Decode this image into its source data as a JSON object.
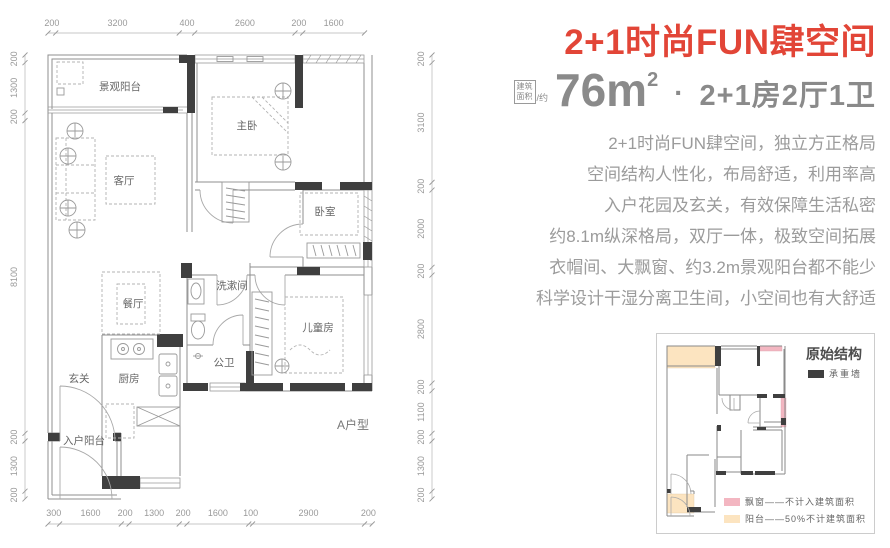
{
  "header": {
    "title": "2+1时尚FUN肆空间",
    "area_badge_top": "建筑",
    "area_badge_bottom": "面积",
    "area_badge_approx": "/约",
    "area_value": "76m",
    "area_sup": "2",
    "separator": "·",
    "layout_spec": "2+1房2厅1卫"
  },
  "description": {
    "lines": [
      "2+1时尚FUN肆空间，独立方正格局",
      "空间结构人性化，布局舒适，利用率高",
      "入户花园及玄关，有效保障生活私密",
      "约8.1m纵深格局，双厅一体，极致空间拓展",
      "衣帽间、大飘窗、约3.2m景观阳台都不能少",
      "科学设计干湿分离卫生间，小空间也有大舒适"
    ]
  },
  "floor_plan": {
    "unit_label": "A户型",
    "rooms": [
      {
        "id": "view-balcony",
        "label": "景观阳台"
      },
      {
        "id": "master-bedroom",
        "label": "主卧"
      },
      {
        "id": "living-room",
        "label": "客厅"
      },
      {
        "id": "bedroom",
        "label": "卧室"
      },
      {
        "id": "washroom",
        "label": "洗漱间"
      },
      {
        "id": "dining-room",
        "label": "餐厅"
      },
      {
        "id": "kids-room",
        "label": "儿童房"
      },
      {
        "id": "bathroom",
        "label": "公卫"
      },
      {
        "id": "kitchen",
        "label": "厨房"
      },
      {
        "id": "foyer",
        "label": "玄关"
      },
      {
        "id": "entry-balcony",
        "label": "入户阳台"
      }
    ],
    "dimensions": {
      "top": [
        200,
        3200,
        400,
        2600,
        200,
        1600
      ],
      "bottom": [
        300,
        1600,
        200,
        1300,
        200,
        1600,
        100,
        2900,
        200
      ],
      "left": [
        200,
        1300,
        200,
        8100,
        200,
        1300,
        200
      ],
      "right": [
        200,
        3100,
        200,
        2000,
        200,
        2800,
        200,
        1100,
        200,
        1300,
        200
      ]
    }
  },
  "mini_plan": {
    "title": "原始结构",
    "wall_legend": "承重墙",
    "bay_window_legend": "飘窗——不计入建筑面积",
    "balcony_legend": "阳台——50%不计建筑面积"
  },
  "colors": {
    "accent_red": "#e24537",
    "stat_gray": "#8a8a8a",
    "body_gray": "#9b9b9b",
    "wall_dark": "#3f3f3f",
    "bay_window_pink": "#f3b6c1",
    "balcony_cream": "#fce4c0"
  }
}
